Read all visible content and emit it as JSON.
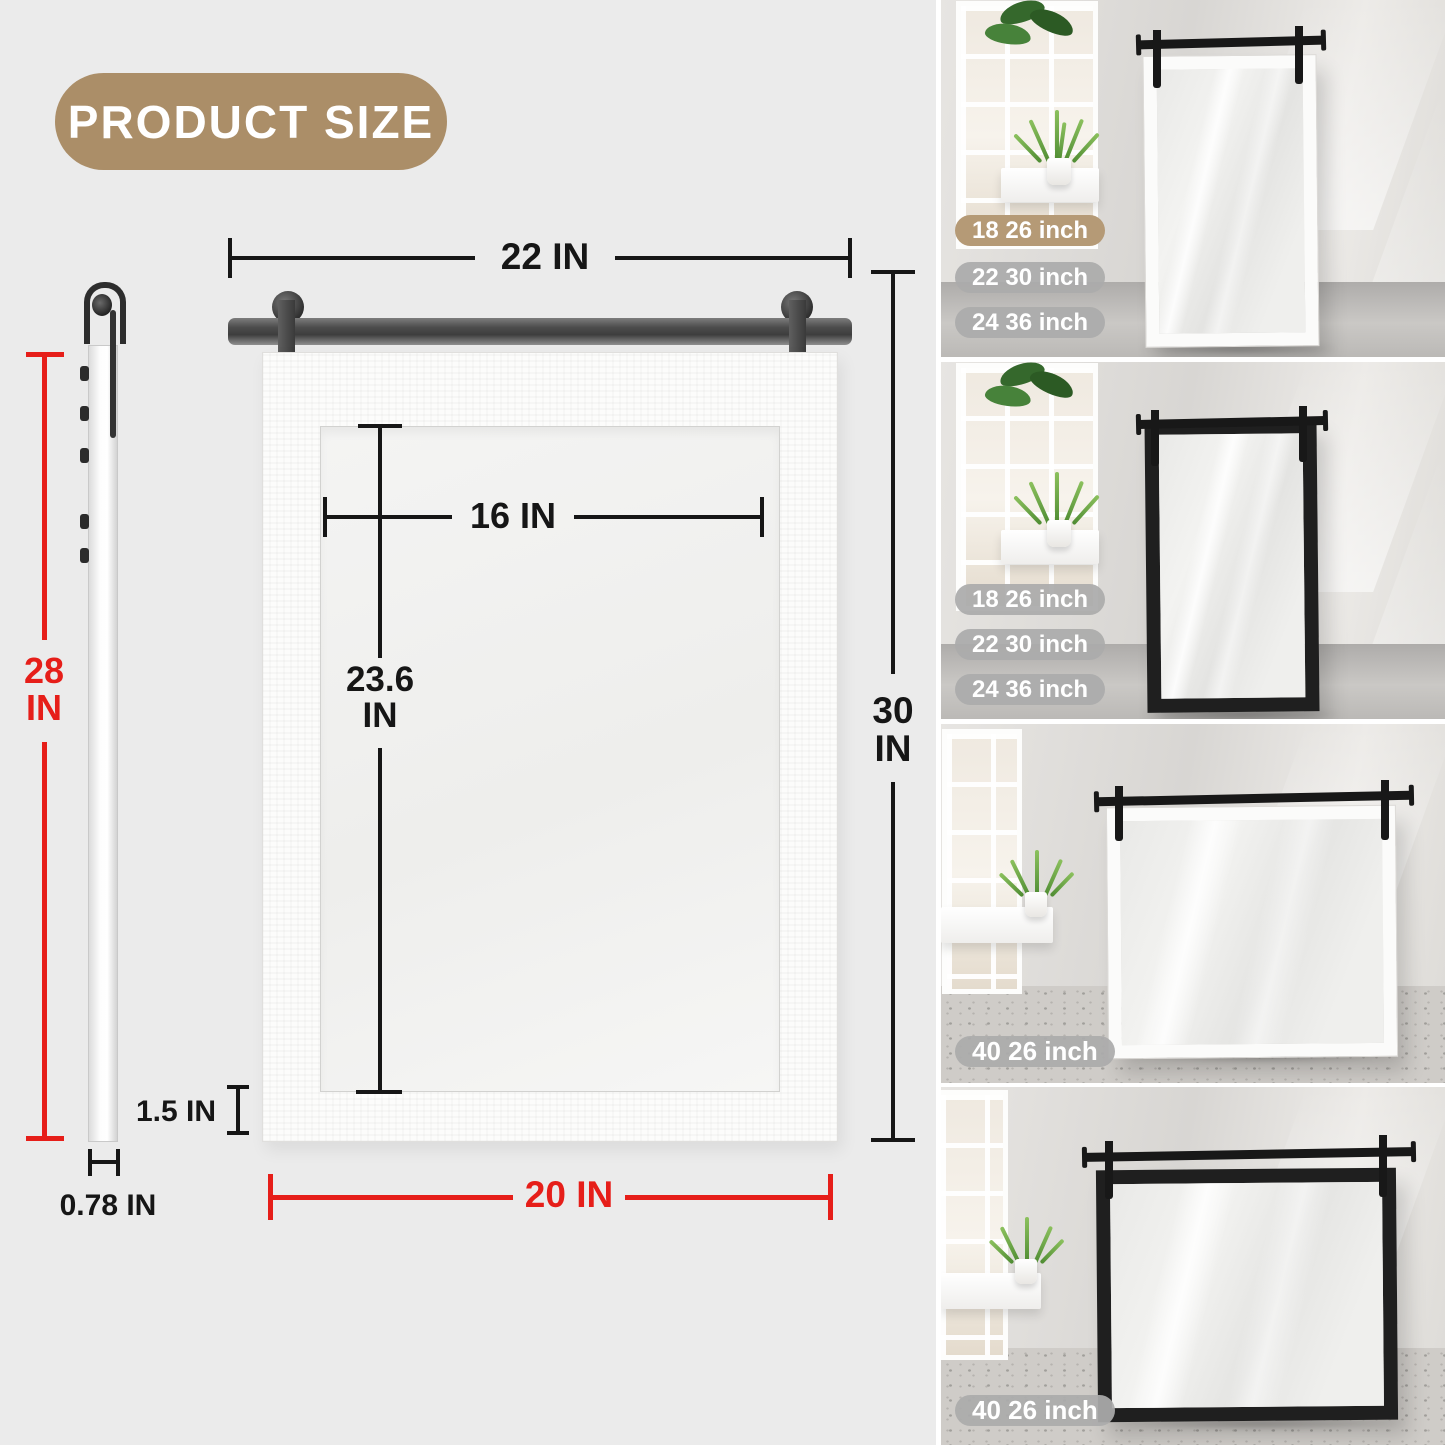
{
  "header": {
    "title": "PRODUCT SIZE"
  },
  "diagram": {
    "dims": {
      "rail_width": "22 IN",
      "inner_width": "16 IN",
      "inner_height_value": "23.6",
      "inner_height_unit": "IN",
      "overall_height_value": "30",
      "overall_height_unit": "IN",
      "side_height_value": "28",
      "side_height_unit": "IN",
      "frame_border": "1.5 IN",
      "overall_width": "20 IN",
      "thickness": "0.78 IN"
    },
    "colors": {
      "accent_tan": "#ab8e68",
      "highlight_red": "#e61e19",
      "dim_black": "#161616",
      "background_gray": "#ebebeb"
    }
  },
  "gallery": {
    "photos": [
      {
        "frame": "white",
        "orientation": "portrait",
        "badges": [
          {
            "label": "18 26 inch",
            "variant": "tan"
          },
          {
            "label": "22 30 inch",
            "variant": "gray"
          },
          {
            "label": "24 36 inch",
            "variant": "gray"
          }
        ]
      },
      {
        "frame": "black",
        "orientation": "portrait",
        "badges": [
          {
            "label": "18 26 inch",
            "variant": "gray"
          },
          {
            "label": "22 30 inch",
            "variant": "gray"
          },
          {
            "label": "24 36 inch",
            "variant": "gray"
          }
        ]
      },
      {
        "frame": "white",
        "orientation": "landscape",
        "badges": [
          {
            "label": "40 26 inch",
            "variant": "gray"
          }
        ]
      },
      {
        "frame": "black",
        "orientation": "landscape",
        "badges": [
          {
            "label": "40 26 inch",
            "variant": "gray"
          }
        ]
      }
    ]
  }
}
